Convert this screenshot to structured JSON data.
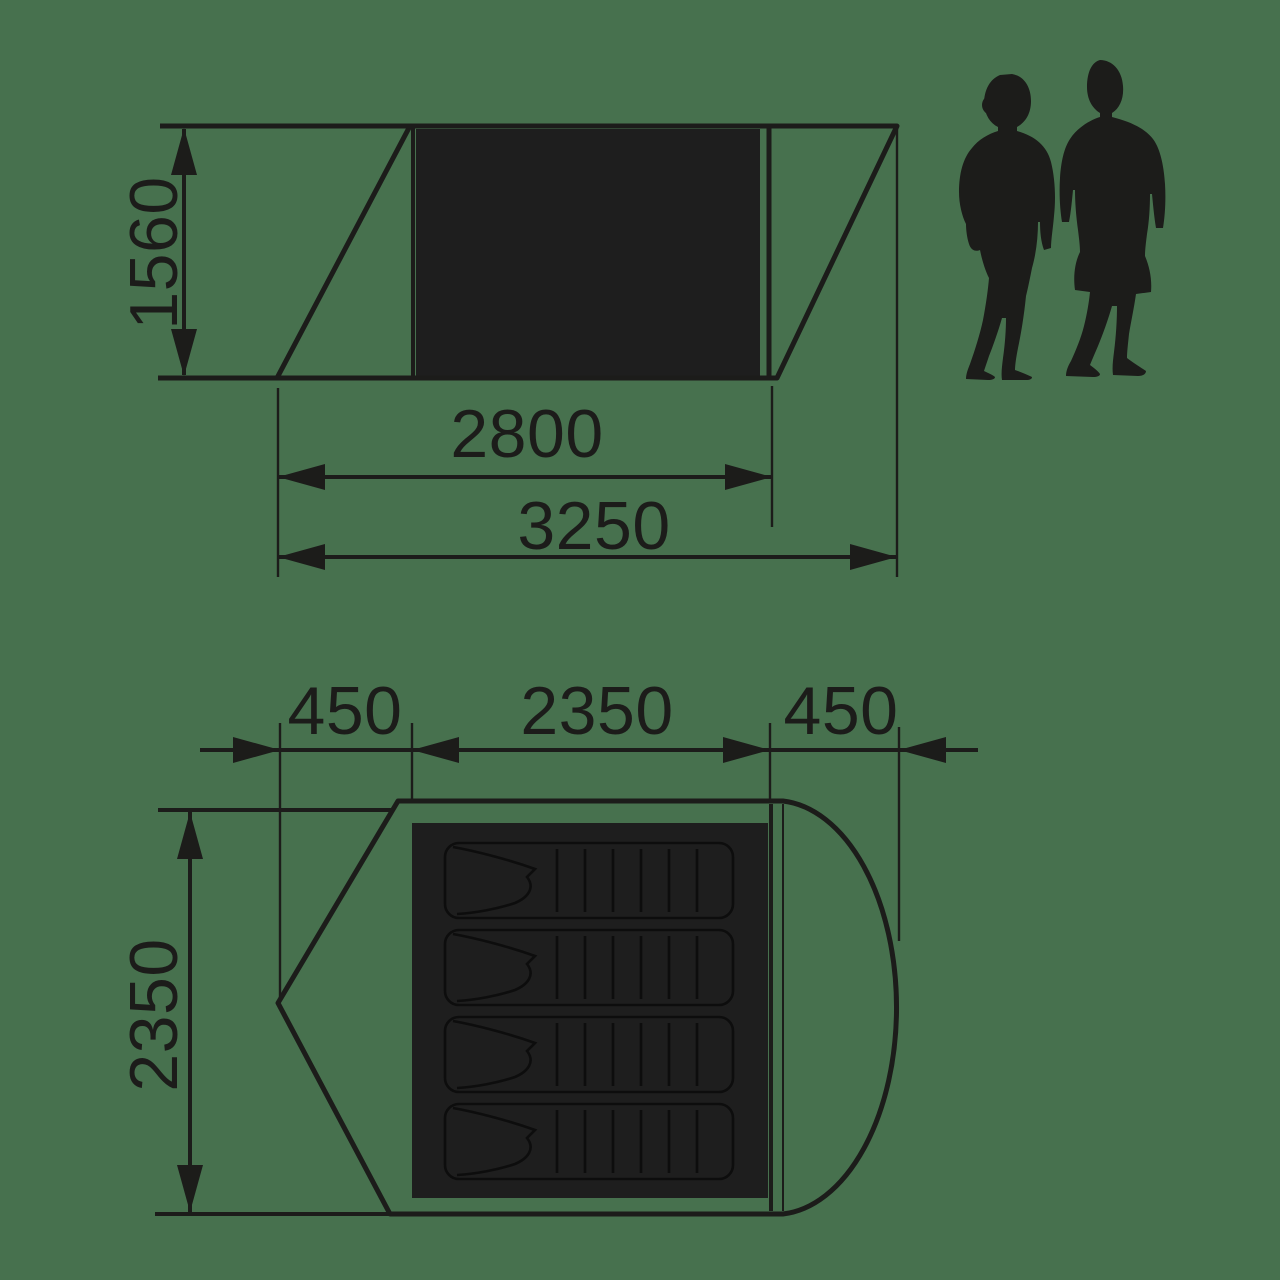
{
  "diagram": {
    "kind": "tent-dimension-drawing",
    "views": [
      "side-elevation",
      "floor-plan"
    ]
  },
  "colors": {
    "background": "#47714e",
    "line": "#1c1c1a",
    "fill_dark": "#1e1e1e",
    "pad_line": "#0d0d0d"
  },
  "side_view": {
    "height_mm": "1560",
    "inner_length_mm": "2800",
    "total_length_mm": "3250"
  },
  "top_view": {
    "left_porch_mm": "450",
    "inner_width_mm": "2350",
    "right_porch_mm": "450",
    "depth_mm": "2350",
    "sleeping_pad_count": 4
  },
  "figures": {
    "left": "woman-silhouette",
    "right": "man-silhouette"
  }
}
